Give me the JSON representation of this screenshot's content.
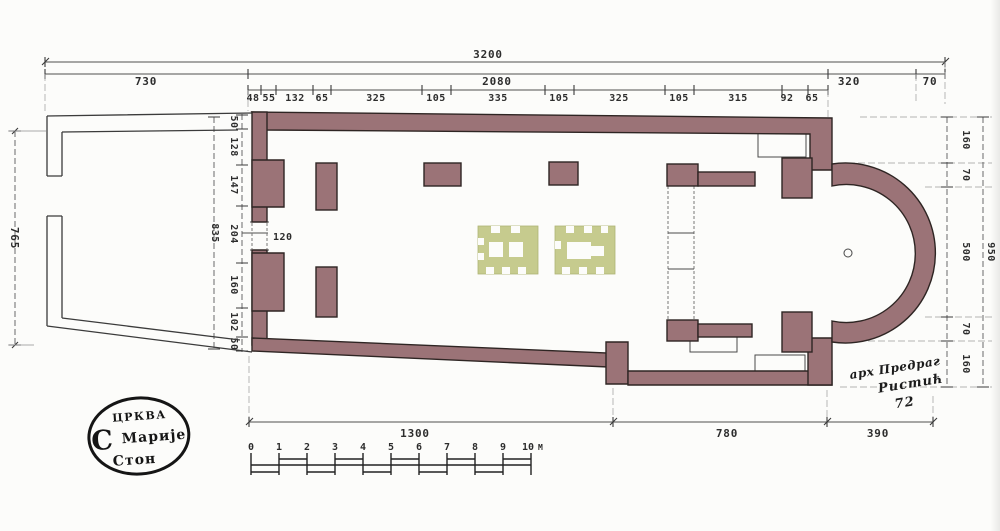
{
  "dimensions": {
    "top": {
      "overall": "3200",
      "row2": [
        "730",
        "2080",
        "320",
        "70"
      ],
      "row3": [
        "48",
        "55",
        "132",
        "65",
        "325",
        "105",
        "335",
        "105",
        "325",
        "105",
        "315",
        "92",
        "65"
      ]
    },
    "left": {
      "outer": "765",
      "overall": "835",
      "chain": [
        "50",
        "128",
        "147",
        "204",
        "160",
        "102",
        "50"
      ],
      "door": "120"
    },
    "right": {
      "overall": "950",
      "chain": [
        "160",
        "70",
        "500",
        "70",
        "160"
      ]
    },
    "bottom": [
      "1300",
      "780",
      "390"
    ]
  },
  "scale_bar": {
    "labels": [
      "0",
      "1",
      "2",
      "3",
      "4",
      "5",
      "6",
      "7",
      "8",
      "9",
      "10"
    ],
    "unit": "M"
  },
  "stamp": {
    "line1": "ЦРКВА",
    "initial": "С",
    "line2": "Марије",
    "line3": "Стон"
  },
  "signature": {
    "line1": "арх Предраг",
    "line2": "Ристић",
    "line3": "72"
  },
  "colors": {
    "wall": "#9b7377",
    "wall_outline": "#2e2523",
    "feature": "#c6cb8e",
    "ink": "#2d2d2d",
    "line": "#4f4f4f",
    "paper": "#fcfcfa"
  }
}
